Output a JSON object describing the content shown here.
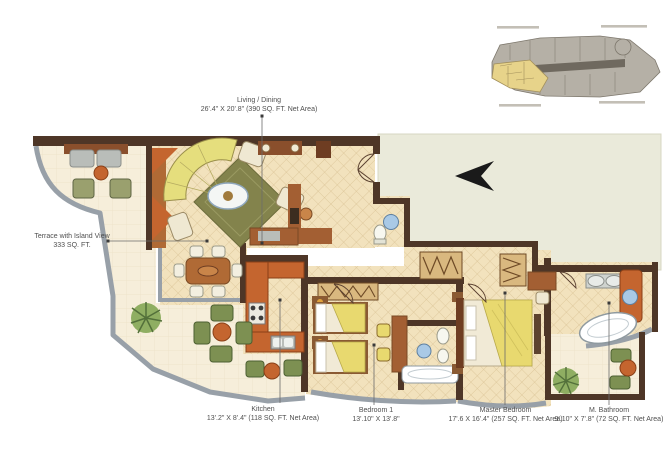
{
  "plan": {
    "labels": {
      "living_dining": {
        "title": "Living / Dining",
        "dims": "26'.4\" X 20'.8\" (390 SQ. FT. Net Area)"
      },
      "terrace": {
        "title": "Terrace with Island View",
        "dims": "333 SQ. FT."
      },
      "kitchen": {
        "title": "Kitchen",
        "dims": "13'.2\" X 8'.4\" (118 SQ. FT. Net Area)"
      },
      "bedroom1": {
        "title": "Bedroom 1",
        "dims": "13'.10\" X 13'.8\""
      },
      "master_bedroom": {
        "title": "Master Bedroom",
        "dims": "17'.6 X 16'.4\" (257 SQ. FT. Net Area)"
      },
      "m_bathroom": {
        "title": "M. Bathroom",
        "dims": "9'.10\" X 7'.8\" (72 SQ. FT. Net Area)"
      }
    },
    "colors": {
      "wall_brown": "#4e3627",
      "floor_tile": "#f2e2bd",
      "floor_lattice_line": "#d9c294",
      "terrace_floor": "#f6eeda",
      "adjacent_area": "#eaeada",
      "rail_gray": "#98a0a8",
      "counter_orange": "#c4652f",
      "sofa_yellow": "#e5de7d",
      "rug_olive": "#83834c",
      "plant_green": "#74934e",
      "fixture_blue": "#a9c9e6",
      "wood_brown": "#a35f33",
      "keyplan_gray": "#b5b0a6",
      "keyplan_unit_yellow": "#e7d38a",
      "label_text": "#4f4f4f"
    }
  }
}
